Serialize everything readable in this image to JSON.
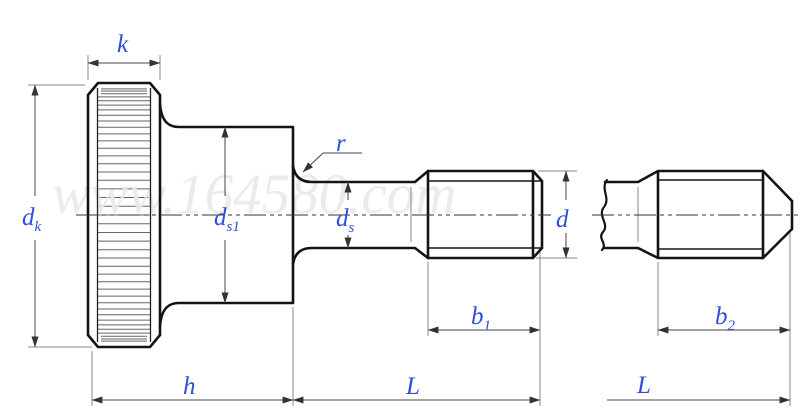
{
  "diagram": {
    "watermark": "www.164580.com",
    "colors": {
      "label": "#2e4ed8",
      "outline": "#141414",
      "dimension": "#454545",
      "watermark": "#e9e9e9"
    },
    "labels": {
      "k": {
        "base": "k",
        "sub": ""
      },
      "d_k": {
        "base": "d",
        "sub": "k"
      },
      "d_s1": {
        "base": "d",
        "sub": "s1"
      },
      "r": {
        "base": "r",
        "sub": ""
      },
      "d_s": {
        "base": "d",
        "sub": "s"
      },
      "d": {
        "base": "d",
        "sub": ""
      },
      "b_1": {
        "base": "b",
        "sub": "1"
      },
      "h": {
        "base": "h",
        "sub": ""
      },
      "L_front": {
        "base": "L",
        "sub": ""
      },
      "b_2": {
        "base": "b",
        "sub": "2"
      },
      "L_end": {
        "base": "L",
        "sub": ""
      }
    }
  }
}
